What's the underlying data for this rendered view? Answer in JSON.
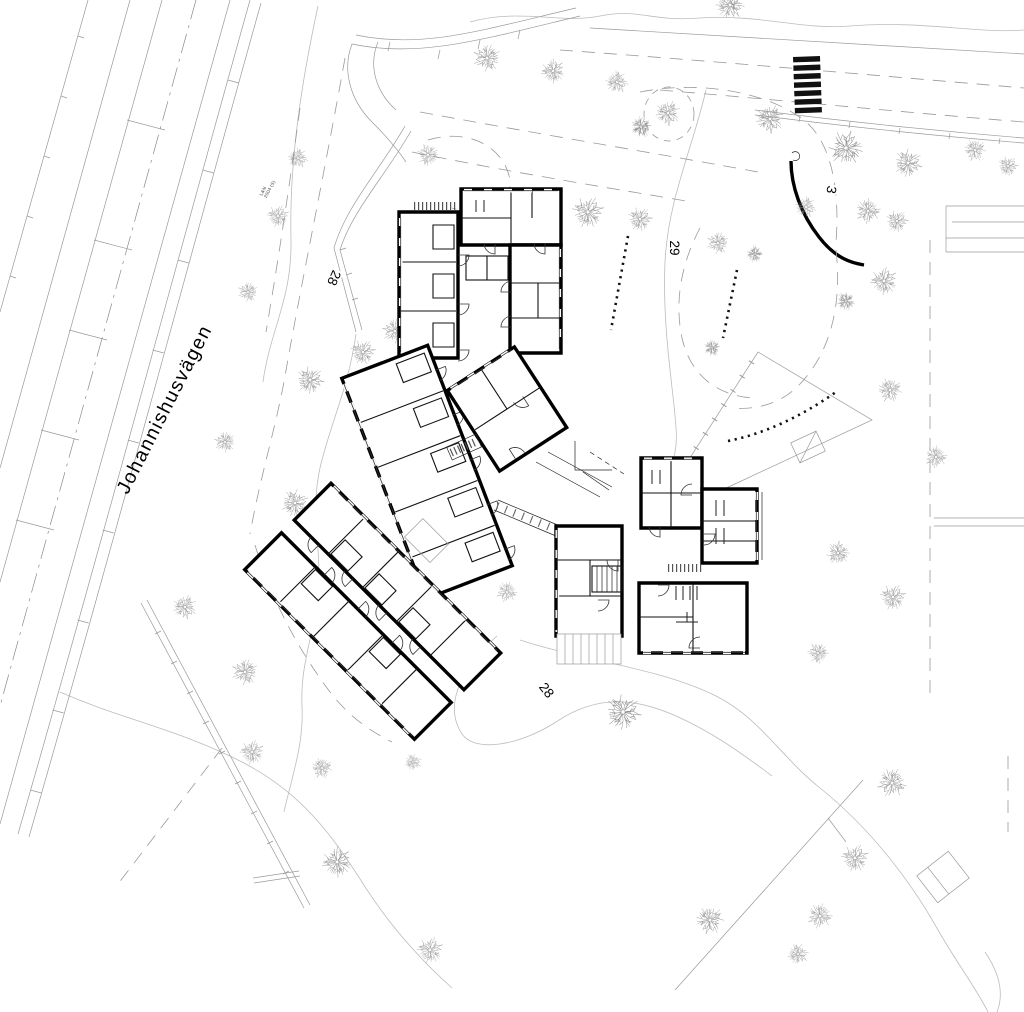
{
  "drawing": {
    "street_label": "Johannishusvägen",
    "contour_labels": [
      {
        "text": "28"
      },
      {
        "text": "29"
      },
      {
        "text": "28"
      },
      {
        "text": "3"
      }
    ],
    "survey_note": {
      "line1": "L&N",
      "line2": "2004 (S)"
    },
    "colors": {
      "ink": "#111111",
      "wall": "#000000",
      "light_line": "#9a9a9a",
      "contour_line": "#bcbcbc",
      "tree": "#8d8d8d"
    },
    "crosswalk": {
      "x": 793,
      "y": 57,
      "stripe_width": 27,
      "stripe_height": 5.4,
      "gap": 3.1,
      "count": 7,
      "rotate": -2
    },
    "trees_xysv": [
      [
        487,
        58,
        0.68,
        "A"
      ],
      [
        553,
        71,
        0.6,
        "A"
      ],
      [
        617,
        82,
        0.56,
        "A"
      ],
      [
        668,
        113,
        0.62,
        "A"
      ],
      [
        641,
        127,
        0.5,
        "B"
      ],
      [
        730,
        5,
        0.7,
        "A"
      ],
      [
        770,
        119,
        0.7,
        "A"
      ],
      [
        846,
        148,
        0.85,
        "A"
      ],
      [
        908,
        163,
        0.7,
        "A"
      ],
      [
        975,
        150,
        0.55,
        "A"
      ],
      [
        1008,
        166,
        0.5,
        "A"
      ],
      [
        806,
        207,
        0.52,
        "A"
      ],
      [
        868,
        211,
        0.62,
        "A"
      ],
      [
        897,
        221,
        0.55,
        "A"
      ],
      [
        884,
        281,
        0.68,
        "A"
      ],
      [
        846,
        301,
        0.45,
        "B"
      ],
      [
        588,
        212,
        0.78,
        "A"
      ],
      [
        640,
        219,
        0.6,
        "A"
      ],
      [
        718,
        243,
        0.55,
        "A"
      ],
      [
        755,
        254,
        0.4,
        "B"
      ],
      [
        712,
        348,
        0.4,
        "B"
      ],
      [
        428,
        155,
        0.55,
        "A"
      ],
      [
        363,
        352,
        0.62,
        "A"
      ],
      [
        298,
        158,
        0.5,
        "A"
      ],
      [
        278,
        216,
        0.55,
        "A"
      ],
      [
        248,
        292,
        0.5,
        "A"
      ],
      [
        395,
        331,
        0.62,
        "A"
      ],
      [
        310,
        380,
        0.68,
        "A"
      ],
      [
        225,
        442,
        0.52,
        "A"
      ],
      [
        295,
        503,
        0.68,
        "A"
      ],
      [
        185,
        607,
        0.6,
        "A"
      ],
      [
        245,
        672,
        0.65,
        "A"
      ],
      [
        252,
        752,
        0.6,
        "A"
      ],
      [
        322,
        768,
        0.52,
        "A"
      ],
      [
        337,
        862,
        0.75,
        "A"
      ],
      [
        430,
        950,
        0.65,
        "A"
      ],
      [
        413,
        762,
        0.42,
        "A"
      ],
      [
        507,
        592,
        0.52,
        "A"
      ],
      [
        623,
        712,
        0.88,
        "A"
      ],
      [
        838,
        553,
        0.58,
        "A"
      ],
      [
        893,
        597,
        0.64,
        "A"
      ],
      [
        818,
        653,
        0.52,
        "A"
      ],
      [
        890,
        390,
        0.6,
        "A"
      ],
      [
        936,
        457,
        0.55,
        "A"
      ],
      [
        892,
        783,
        0.72,
        "A"
      ],
      [
        855,
        858,
        0.68,
        "A"
      ],
      [
        820,
        916,
        0.62,
        "A"
      ],
      [
        798,
        954,
        0.52,
        "A"
      ],
      [
        710,
        920,
        0.7,
        "A"
      ]
    ]
  }
}
